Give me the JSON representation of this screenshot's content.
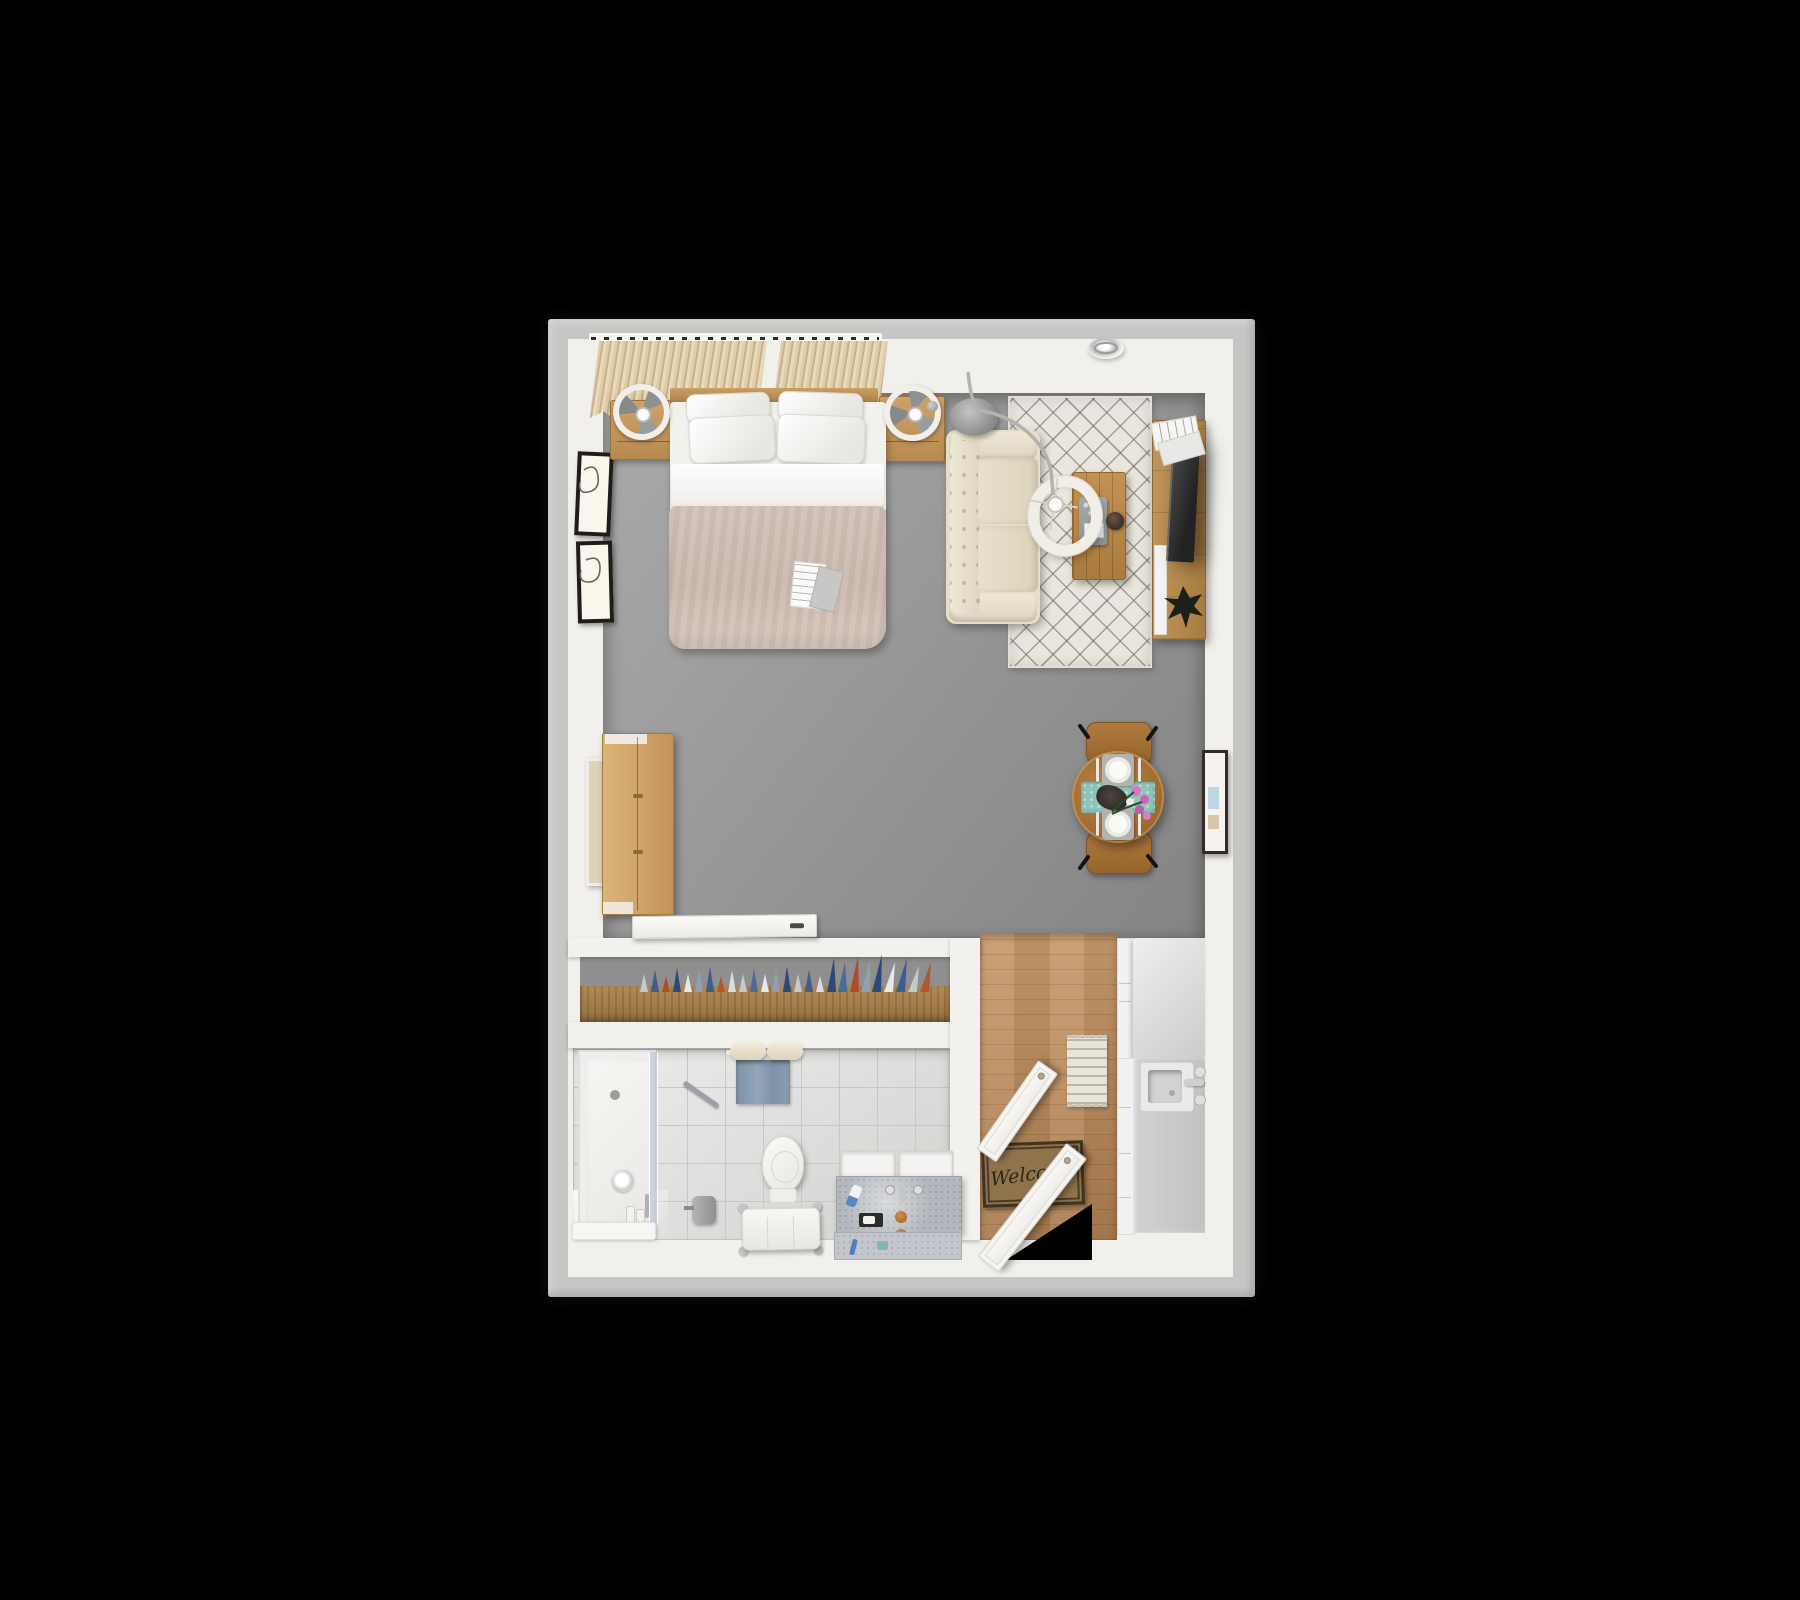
{
  "scene": {
    "type": "3d-floor-plan-top-view",
    "subject": "studio apartment rendering",
    "background_color": "#000000",
    "frame_color": "#c7c6c4",
    "wall_color": "#f2f0ec"
  },
  "text": {
    "doormat": "Welcome"
  },
  "palette": {
    "carpet": "#999999",
    "wood_light": "#c29a62",
    "wood_floor": "#bd9164",
    "wood_table": "#a26c2e",
    "duvet_blush": "#cfbcb1",
    "sofa_beige": "#e6dec9",
    "rug_cream": "#eae6dd",
    "runner_teal": "#8fc4ba",
    "towel_blue": "#7d92a6",
    "flower_pink": "#d678c6",
    "tile_gray": "#dedddb",
    "counter_gray": "#c7c7c5",
    "tv_black": "#2b2b2b"
  },
  "rooms": [
    {
      "name": "sleeping-area",
      "items": [
        "curtain-panels",
        "double-bed",
        "pillows",
        "duvet",
        "magazine",
        "nightstand-left",
        "fan-lamp",
        "nightstand-right",
        "ring-lamp",
        "wall-art-frames"
      ]
    },
    {
      "name": "living-area",
      "items": [
        "ceiling-light",
        "diamond-rug",
        "sofa",
        "arc-floor-lamp",
        "coffee-table",
        "tray",
        "bowl",
        "tv-console",
        "tv",
        "magazines",
        "plant"
      ]
    },
    {
      "name": "dining-area",
      "items": [
        "round-table",
        "two-chairs",
        "teal-runner",
        "plates",
        "cutlery",
        "flowers",
        "wall-art"
      ]
    },
    {
      "name": "closet",
      "items": [
        "sliding-door",
        "hanging-clothes",
        "wardrobe",
        "leaning-mirror"
      ]
    },
    {
      "name": "bathroom",
      "items": [
        "walk-in-shower",
        "glass-panel",
        "grab-bar",
        "towel-rolls",
        "blue-towel",
        "toilet",
        "paper-holder",
        "bench",
        "double-vanity",
        "bath-mat"
      ]
    },
    {
      "name": "kitchen-entry",
      "items": [
        "wood-floor",
        "runner-rug",
        "fridge",
        "counter",
        "sink",
        "faucet",
        "welcome-mat",
        "entry-door",
        "bathroom-door"
      ]
    }
  ]
}
